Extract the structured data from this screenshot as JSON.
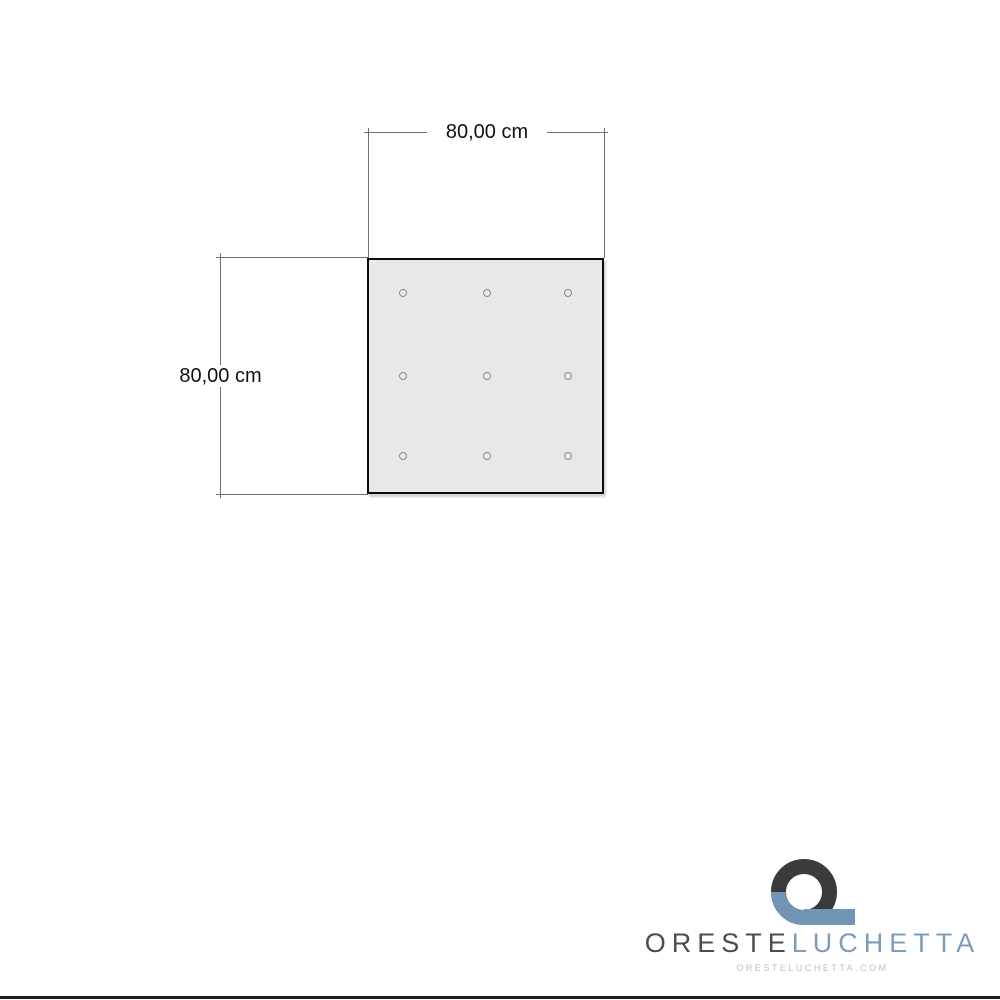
{
  "drawing": {
    "width_dimension": {
      "label": "80,00 cm"
    },
    "height_dimension": {
      "label": "80,00 cm"
    },
    "panel": {
      "shape": "square",
      "holes_rows": 3,
      "holes_cols": 3,
      "holes_count": 9,
      "fill_color": "#e8e8e8",
      "border_color": "#0d0d0d"
    }
  },
  "branding": {
    "brand_primary": "ORESTE",
    "brand_secondary": "LUCHETTA",
    "website": "ORESTELUCHETTA.COM",
    "colors": {
      "dark": "#3b3b3b",
      "blue": "#7295b5",
      "text_primary": "#4c4c4c",
      "text_secondary": "#7b9cbb",
      "website_text": "#b5c2cd"
    }
  }
}
